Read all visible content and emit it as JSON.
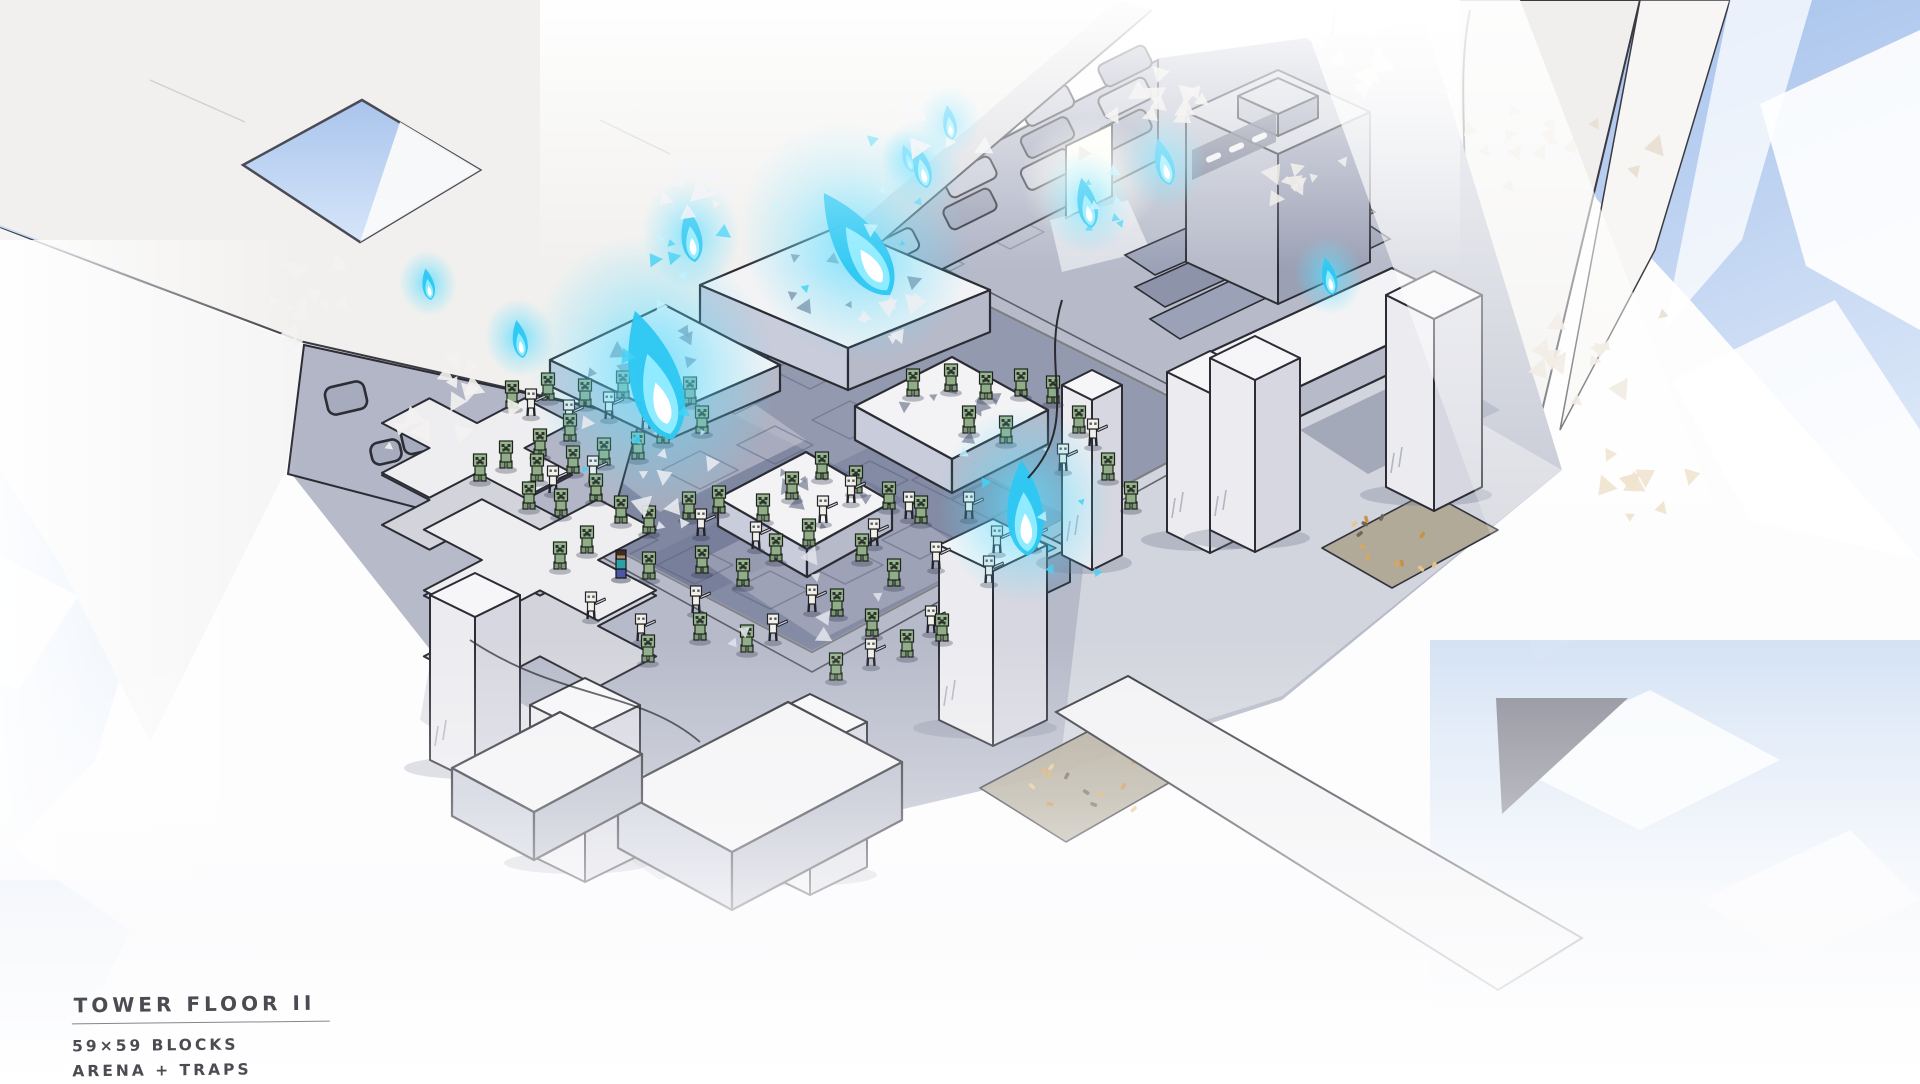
{
  "annotation": {
    "title": "TOWER FLOOR II",
    "line1": "59×59 BLOCKS",
    "line2": "ARENA + TRAPS"
  },
  "palette": {
    "flame_outer": "#2ec8f2",
    "flame_mid": "#8febff",
    "flame_core": "#ffffff",
    "flame_glow": "#5adcff",
    "creeper_green": "#8fae88",
    "creeper_dark": "#2c332b",
    "skeleton_bone": "#f1f1ea",
    "player_shirt": "#2f9fa6",
    "player_pants": "#4d55a8",
    "player_hair": "#3a2d23",
    "ink_outline": "#2b2c34",
    "pit_floor": "#939aaf",
    "marble_white": "#f3f3f5",
    "sky_blue": "#a9c4ec",
    "amber": "#d8a75f"
  },
  "scene": {
    "flames": [
      {
        "x": 672,
        "y": 440,
        "s": 2.1,
        "tilt": -16
      },
      {
        "x": 695,
        "y": 262,
        "s": 0.85,
        "tilt": -8
      },
      {
        "x": 890,
        "y": 295,
        "s": 1.9,
        "tilt": -33
      },
      {
        "x": 523,
        "y": 358,
        "s": 0.6,
        "tilt": -10
      },
      {
        "x": 431,
        "y": 300,
        "s": 0.5,
        "tilt": -10
      },
      {
        "x": 913,
        "y": 172,
        "s": 0.45,
        "tilt": -20
      },
      {
        "x": 927,
        "y": 188,
        "s": 0.7,
        "tilt": -14
      },
      {
        "x": 952,
        "y": 140,
        "s": 0.55,
        "tilt": -8
      },
      {
        "x": 1092,
        "y": 228,
        "s": 0.8,
        "tilt": -12
      },
      {
        "x": 1170,
        "y": 185,
        "s": 0.75,
        "tilt": -15
      },
      {
        "x": 1333,
        "y": 295,
        "s": 0.6,
        "tilt": -12
      },
      {
        "x": 1028,
        "y": 556,
        "s": 1.5,
        "tilt": -4
      }
    ],
    "mobs": {
      "creepers": [
        [
          512,
          408
        ],
        [
          548,
          400
        ],
        [
          585,
          406
        ],
        [
          623,
          398
        ],
        [
          656,
          416
        ],
        [
          690,
          404
        ],
        [
          570,
          441
        ],
        [
          540,
          456
        ],
        [
          506,
          468
        ],
        [
          480,
          481
        ],
        [
          537,
          481
        ],
        [
          573,
          473
        ],
        [
          604,
          465
        ],
        [
          638,
          459
        ],
        [
          663,
          443
        ],
        [
          702,
          433
        ],
        [
          596,
          501
        ],
        [
          561,
          516
        ],
        [
          529,
          509
        ],
        [
          621,
          523
        ],
        [
          649,
          533
        ],
        [
          689,
          519
        ],
        [
          719,
          513
        ],
        [
          587,
          553
        ],
        [
          560,
          569
        ],
        [
          649,
          579
        ],
        [
          702,
          573
        ],
        [
          743,
          586
        ],
        [
          776,
          561
        ],
        [
          809,
          546
        ],
        [
          763,
          521
        ],
        [
          792,
          499
        ],
        [
          822,
          479
        ],
        [
          856,
          493
        ],
        [
          889,
          509
        ],
        [
          921,
          523
        ],
        [
          862,
          561
        ],
        [
          894,
          586
        ],
        [
          837,
          616
        ],
        [
          872,
          636
        ],
        [
          907,
          657
        ],
        [
          942,
          641
        ],
        [
          913,
          396
        ],
        [
          951,
          391
        ],
        [
          986,
          399
        ],
        [
          1021,
          396
        ],
        [
          1053,
          403
        ],
        [
          969,
          433
        ],
        [
          1006,
          443
        ],
        [
          1079,
          433
        ],
        [
          1108,
          480
        ],
        [
          1131,
          509
        ],
        [
          747,
          652
        ],
        [
          700,
          640
        ],
        [
          648,
          662
        ],
        [
          836,
          680
        ]
      ],
      "skeletons": [
        [
          531,
          416
        ],
        [
          609,
          419
        ],
        [
          569,
          427
        ],
        [
          646,
          429
        ],
        [
          593,
          483
        ],
        [
          553,
          493
        ],
        [
          701,
          536
        ],
        [
          756,
          549
        ],
        [
          823,
          523
        ],
        [
          851,
          503
        ],
        [
          909,
          519
        ],
        [
          969,
          519
        ],
        [
          997,
          553
        ],
        [
          1033,
          549
        ],
        [
          874,
          546
        ],
        [
          936,
          569
        ],
        [
          989,
          583
        ],
        [
          696,
          613
        ],
        [
          773,
          641
        ],
        [
          931,
          633
        ],
        [
          871,
          666
        ],
        [
          641,
          641
        ],
        [
          591,
          619
        ],
        [
          1063,
          471
        ],
        [
          1093,
          446
        ],
        [
          812,
          612
        ]
      ],
      "player": {
        "x": 621,
        "y": 578
      }
    },
    "platforms": [
      {
        "pts": [
          [
            700,
            285
          ],
          [
            840,
            226
          ],
          [
            990,
            290
          ],
          [
            848,
            348
          ]
        ],
        "h": 42
      },
      {
        "pts": [
          [
            550,
            360
          ],
          [
            665,
            305
          ],
          [
            780,
            365
          ],
          [
            665,
            415
          ]
        ],
        "h": 26
      },
      {
        "pts": [
          [
            855,
            406
          ],
          [
            952,
            357
          ],
          [
            1048,
            410
          ],
          [
            952,
            459
          ]
        ],
        "h": 34
      },
      {
        "pts": [
          [
            718,
            498
          ],
          [
            806,
            452
          ],
          [
            892,
            502
          ],
          [
            807,
            549
          ]
        ],
        "h": 28
      },
      {
        "pts": [
          [
            1210,
            352
          ],
          [
            1392,
            268
          ],
          [
            1470,
            306
          ],
          [
            1288,
            392
          ]
        ],
        "h": 30,
        "plain": true
      },
      {
        "pts": [
          [
            618,
            790
          ],
          [
            788,
            702
          ],
          [
            902,
            762
          ],
          [
            732,
            852
          ]
        ],
        "h": 58,
        "plain": true,
        "layer": "fg"
      },
      {
        "pts": [
          [
            452,
            768
          ],
          [
            560,
            712
          ],
          [
            642,
            754
          ],
          [
            534,
            812
          ]
        ],
        "h": 48,
        "plain": true,
        "layer": "fg"
      }
    ],
    "pillars": [
      {
        "cx": 475,
        "ty": 595,
        "a": 45,
        "b": 22,
        "h": 165
      },
      {
        "cx": 585,
        "ty": 705,
        "a": 55,
        "b": 27,
        "h": 150
      },
      {
        "cx": 810,
        "ty": 722,
        "a": 57,
        "b": 28,
        "h": 145
      },
      {
        "cx": 993,
        "ty": 545,
        "a": 54,
        "b": 26,
        "h": 175
      },
      {
        "cx": 1092,
        "ty": 385,
        "a": 30,
        "b": 15,
        "h": 170
      },
      {
        "cx": 1210,
        "ty": 372,
        "a": 43,
        "b": 21,
        "h": 160
      },
      {
        "cx": 1255,
        "ty": 358,
        "a": 45,
        "b": 22,
        "h": 172
      },
      {
        "cx": 1434,
        "ty": 295,
        "a": 48,
        "b": 24,
        "h": 192
      }
    ],
    "grey_boxes": [
      {
        "cx": 1278,
        "ty": 112,
        "a": 92,
        "b": 42,
        "h": 150
      },
      {
        "cx": 1278,
        "ty": 96,
        "a": 40,
        "b": 18,
        "h": 22
      },
      {
        "cx": 697,
        "ty": 252,
        "a": 36,
        "b": 17,
        "h": 26
      },
      {
        "cx": 1030,
        "ty": 548,
        "a": 40,
        "b": 19,
        "h": 34
      },
      {
        "cx": 660,
        "ty": 140,
        "a": 24,
        "b": 12,
        "h": 28
      },
      {
        "cx": 730,
        "ty": 112,
        "a": 24,
        "b": 12,
        "h": 28
      },
      {
        "cx": 800,
        "ty": 140,
        "a": 24,
        "b": 12,
        "h": 28
      },
      {
        "cx": 870,
        "ty": 90,
        "a": 24,
        "b": 12,
        "h": 28
      },
      {
        "cx": 940,
        "ty": 118,
        "a": 24,
        "b": 12,
        "h": 28
      }
    ],
    "cyan_basins": [
      {
        "cx": 697,
        "ty": 252,
        "a": 22,
        "b": 10
      },
      {
        "cx": 1030,
        "ty": 548,
        "a": 26,
        "b": 12
      }
    ],
    "crosses": [
      {
        "cx": 477,
        "cy": 448,
        "s": 27,
        "h": 52
      },
      {
        "cx": 540,
        "cy": 560,
        "s": 33,
        "h": 66
      }
    ],
    "pools": [
      {
        "pts": [
          [
            980,
            788
          ],
          [
            1102,
            724
          ],
          [
            1188,
            772
          ],
          [
            1066,
            842
          ]
        ]
      },
      {
        "pts": [
          [
            1322,
            548
          ],
          [
            1428,
            492
          ],
          [
            1498,
            530
          ],
          [
            1392,
            588
          ]
        ]
      },
      {
        "pts": [
          [
            655,
            800
          ],
          [
            768,
            740
          ],
          [
            838,
            782
          ],
          [
            724,
            844
          ]
        ]
      }
    ],
    "wall_frames": [
      {
        "x": 428,
        "y": 432,
        "w": 54,
        "h": 36
      },
      {
        "x": 462,
        "y": 488,
        "w": 46,
        "h": 36
      },
      {
        "x": 346,
        "y": 398,
        "w": 40,
        "h": 28
      },
      {
        "x": 386,
        "y": 452,
        "w": 30,
        "h": 22
      }
    ],
    "debris_clusters": [
      {
        "x": 300,
        "y": 300,
        "r": 95,
        "n": 13,
        "c": "#f3f2ef"
      },
      {
        "x": 470,
        "y": 390,
        "r": 70,
        "n": 8,
        "c": "#f3f2ef"
      },
      {
        "x": 700,
        "y": 200,
        "r": 60,
        "n": 9,
        "c": "#eef0f4"
      },
      {
        "x": 950,
        "y": 120,
        "r": 70,
        "n": 9,
        "c": "#eef0f4"
      },
      {
        "x": 1150,
        "y": 120,
        "r": 85,
        "n": 12,
        "c": "#e9e7e2"
      },
      {
        "x": 1300,
        "y": 180,
        "r": 70,
        "n": 9,
        "c": "#e9e7e2"
      },
      {
        "x": 1550,
        "y": 140,
        "r": 110,
        "n": 14,
        "c": "#e8dfd0"
      },
      {
        "x": 1600,
        "y": 350,
        "r": 90,
        "n": 12,
        "c": "#e8dfd0"
      },
      {
        "x": 1630,
        "y": 480,
        "r": 70,
        "n": 9,
        "c": "#ead9bd"
      },
      {
        "x": 870,
        "y": 320,
        "r": 60,
        "n": 8,
        "c": "#eceef2"
      },
      {
        "x": 420,
        "y": 430,
        "r": 45,
        "n": 6,
        "c": "#f3f2ef"
      },
      {
        "x": 1380,
        "y": 60,
        "r": 80,
        "n": 10,
        "c": "#f0ede8"
      },
      {
        "x": 640,
        "y": 480,
        "r": 110,
        "n": 9,
        "c": "#e8eaf0"
      },
      {
        "x": 800,
        "y": 610,
        "r": 95,
        "n": 7,
        "c": "#dfe2ea"
      }
    ]
  }
}
